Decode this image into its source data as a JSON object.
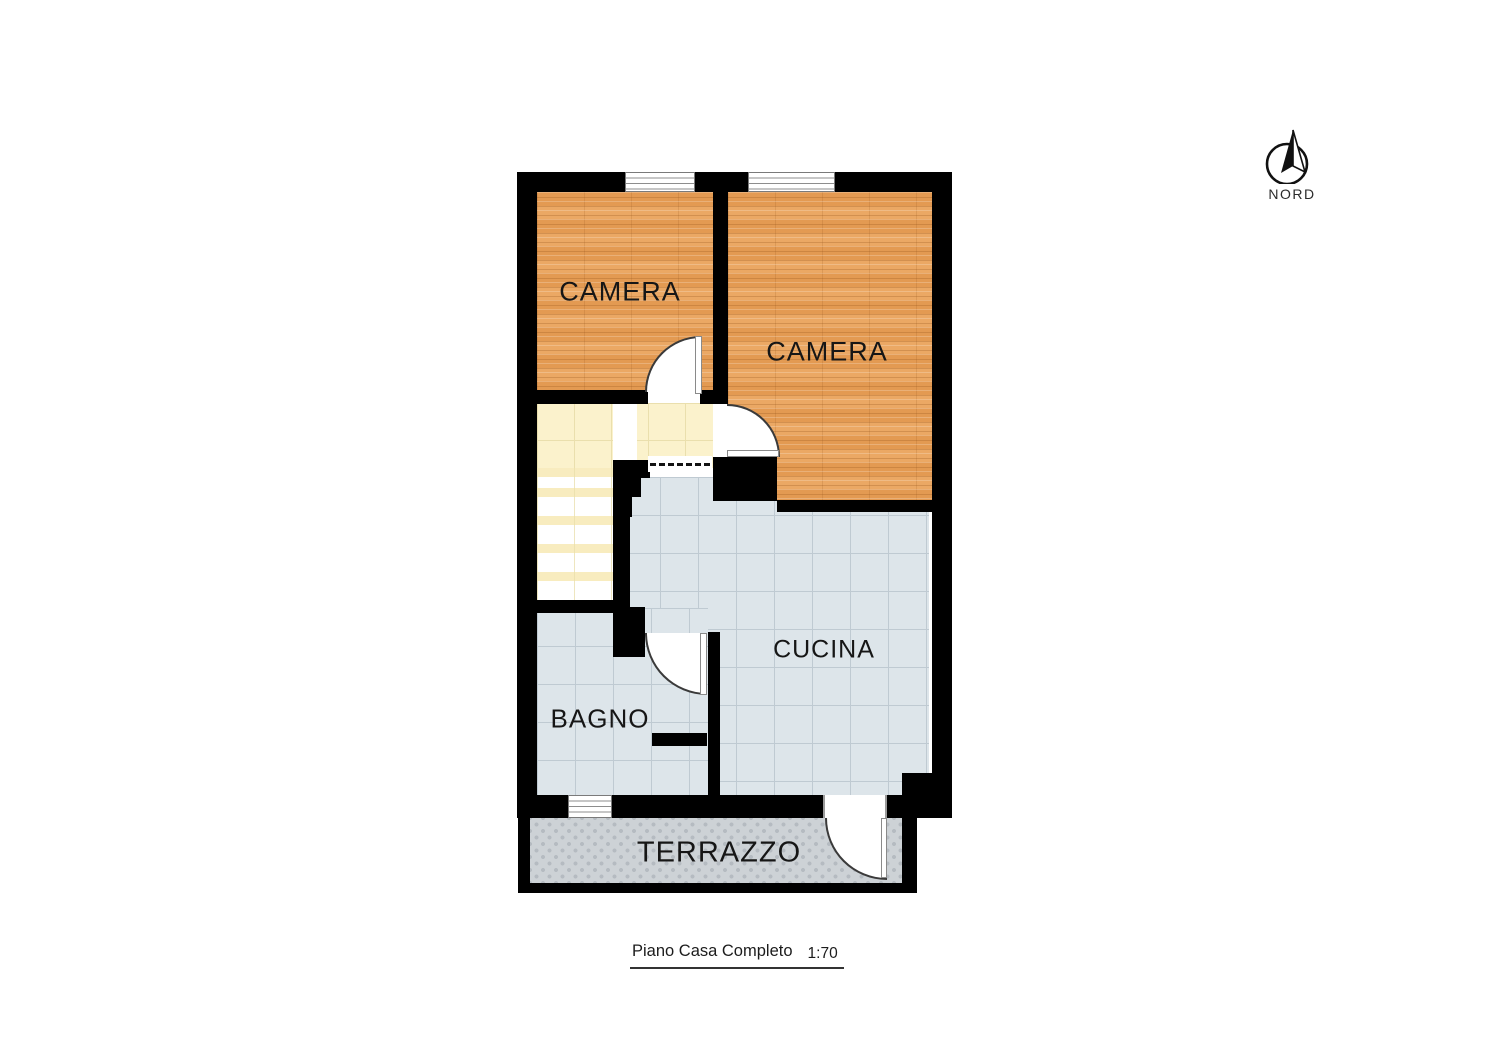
{
  "page": {
    "background_color": "#ffffff"
  },
  "plan": {
    "title": "Piano Casa Completo",
    "scale": "1:70",
    "compass": {
      "label": "NORD",
      "icon": "north-arrow-icon"
    },
    "rooms": [
      {
        "id": "camera-1",
        "label": "CAMERA",
        "floor_type": "wood-parquet",
        "floor_color": "#e7a15b"
      },
      {
        "id": "camera-2",
        "label": "CAMERA",
        "floor_type": "wood-parquet",
        "floor_color": "#e7a15b"
      },
      {
        "id": "cucina",
        "label": "CUCINA",
        "floor_type": "ceramic-tile",
        "floor_color": "#dde5ea"
      },
      {
        "id": "bagno",
        "label": "BAGNO",
        "floor_type": "ceramic-tile",
        "floor_color": "#dde5ea"
      },
      {
        "id": "terrazzo",
        "label": "TERRAZZO",
        "floor_type": "outdoor-tile",
        "floor_color": "#cdd2d6"
      }
    ],
    "hall_floor_color": "#fbf2cc",
    "stairs_tread_color": "#f8ecbf",
    "wall_color": "#000000"
  }
}
